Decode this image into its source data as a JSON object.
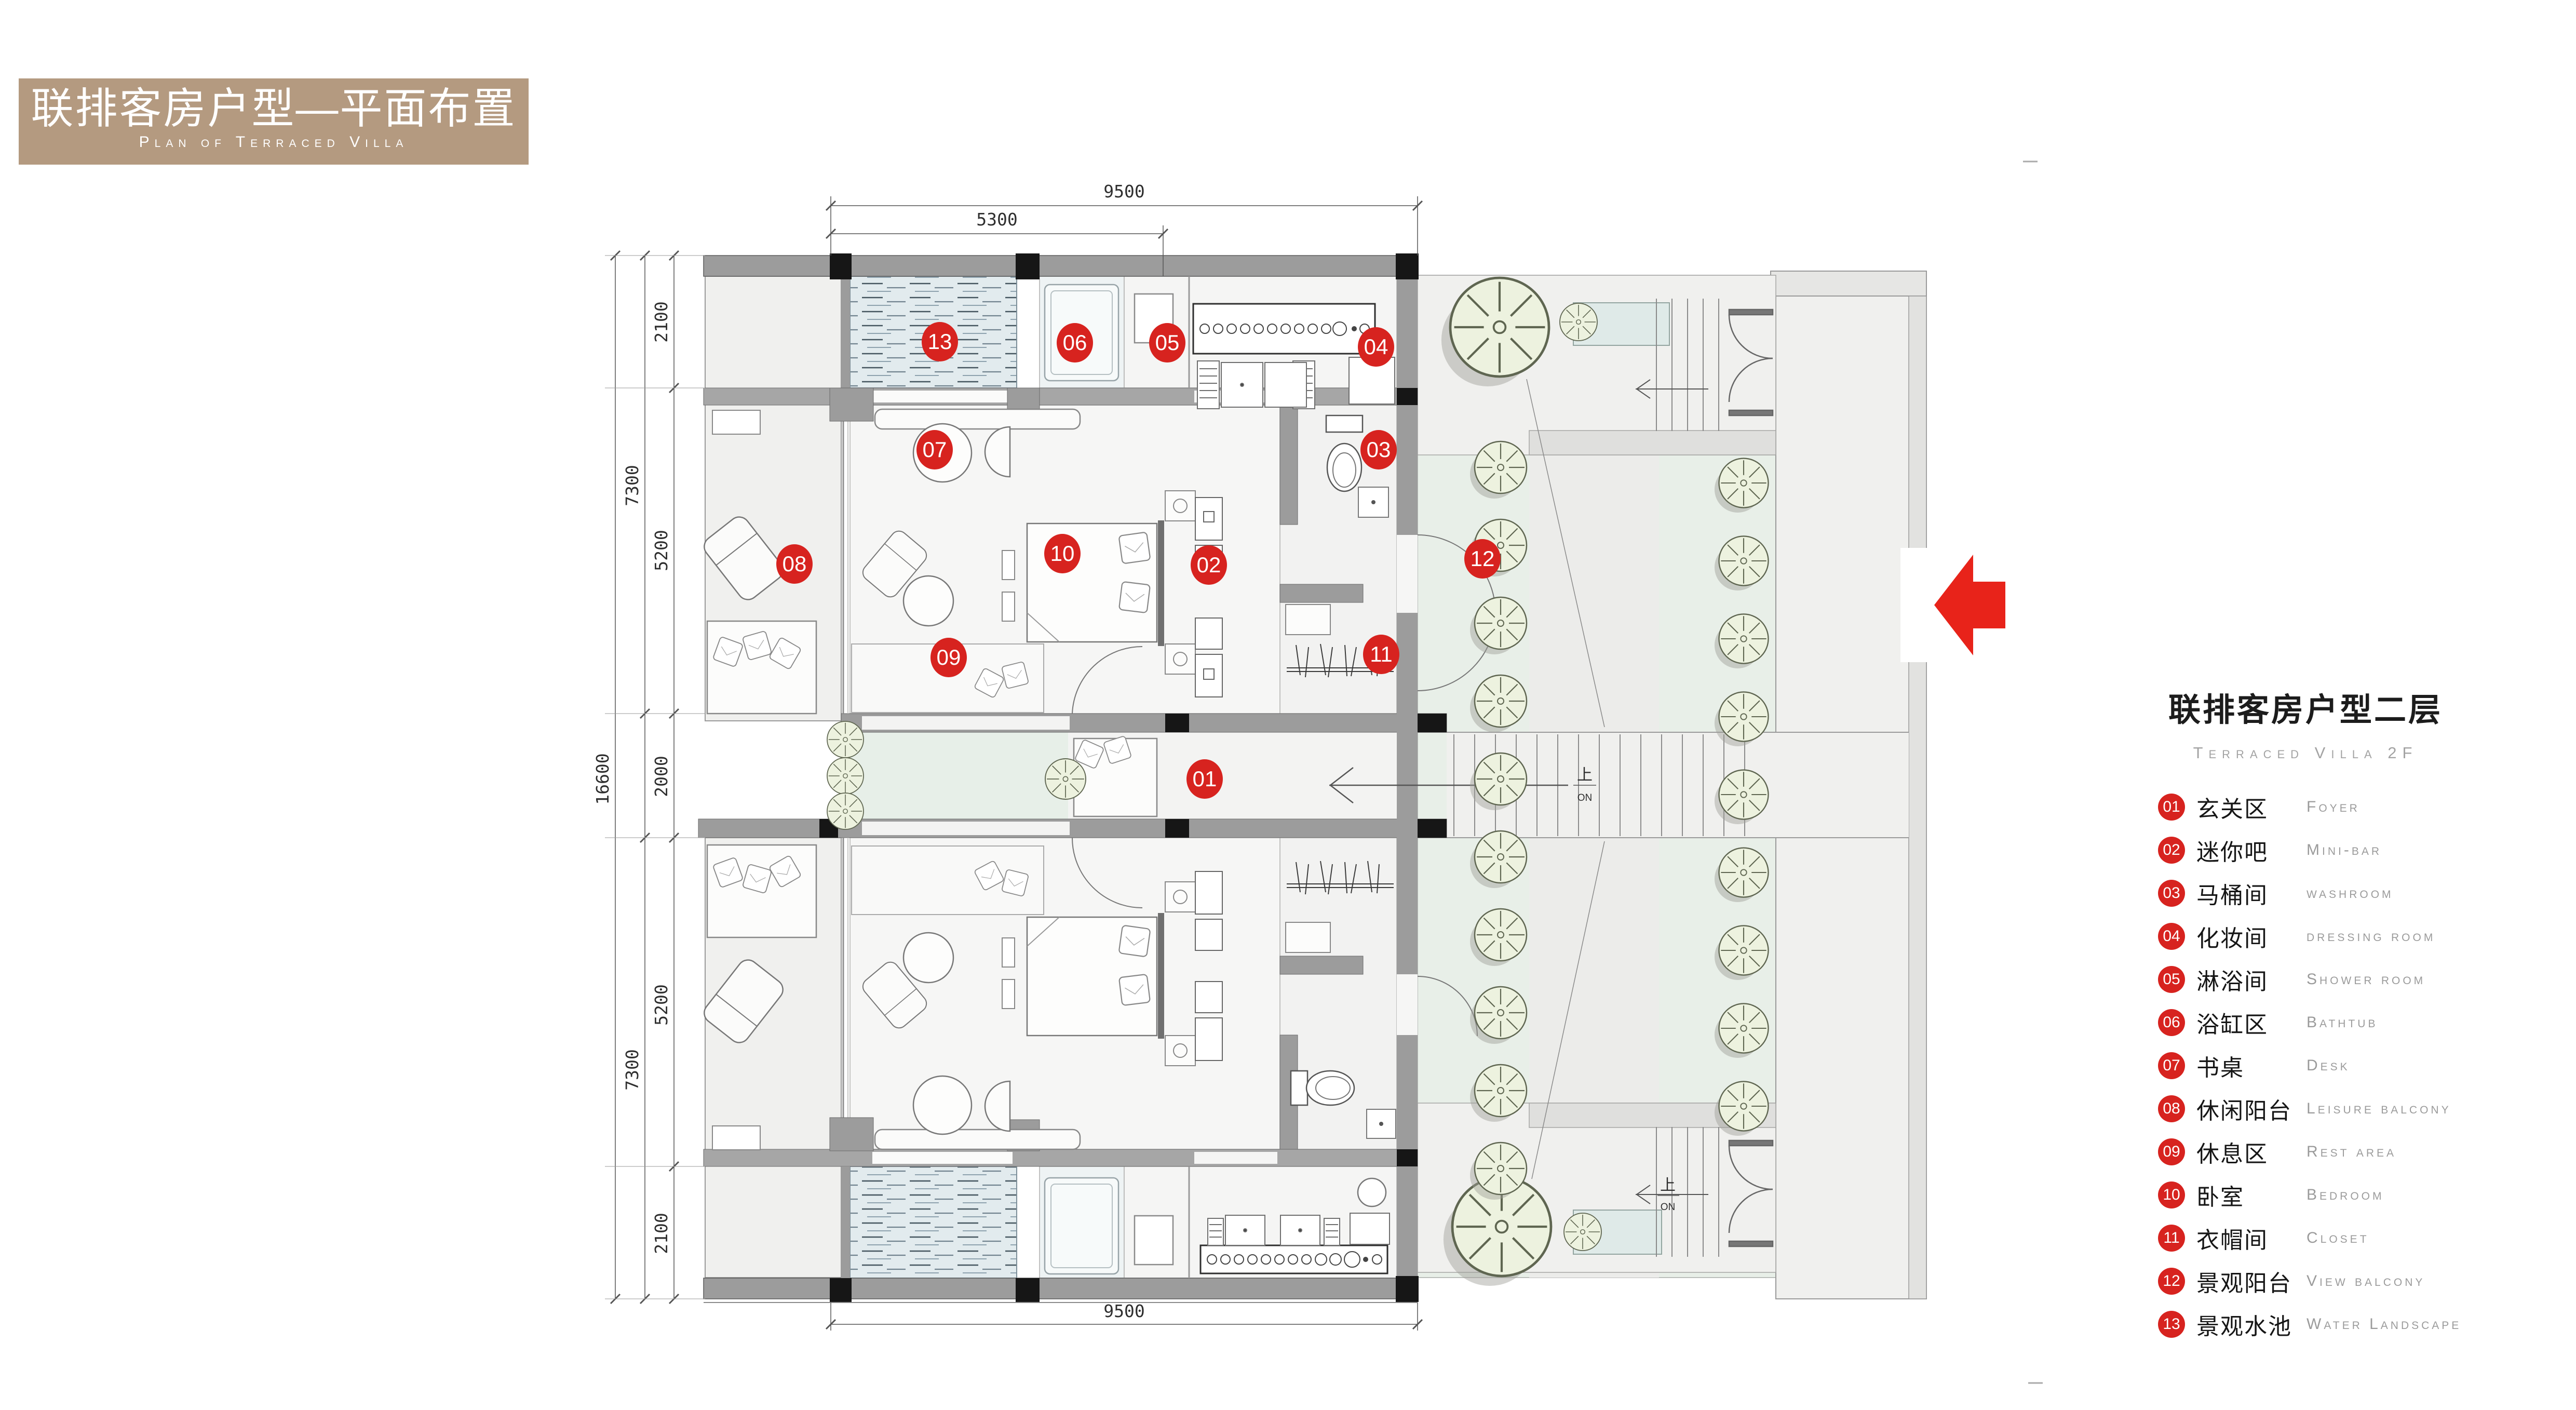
{
  "header": {
    "title_zh": "联排客房户型—平面布置",
    "title_en": "Plan of Terraced Villa"
  },
  "legend": {
    "title_zh": "联排客房户型二层",
    "title_en": "Terraced Villa  2F",
    "items": [
      {
        "num": "01",
        "zh": "玄关区",
        "en": "Foyer"
      },
      {
        "num": "02",
        "zh": "迷你吧",
        "en": "Mini-bar"
      },
      {
        "num": "03",
        "zh": "马桶间",
        "en": "washroom"
      },
      {
        "num": "04",
        "zh": "化妆间",
        "en": "dressing room"
      },
      {
        "num": "05",
        "zh": "淋浴间",
        "en": "Shower room"
      },
      {
        "num": "06",
        "zh": "浴缸区",
        "en": "Bathtub"
      },
      {
        "num": "07",
        "zh": "书桌",
        "en": "Desk"
      },
      {
        "num": "08",
        "zh": "休闲阳台",
        "en": "Leisure balcony"
      },
      {
        "num": "09",
        "zh": "休息区",
        "en": "Rest area"
      },
      {
        "num": "10",
        "zh": "卧室",
        "en": "Bedroom"
      },
      {
        "num": "11",
        "zh": "衣帽间",
        "en": "Closet"
      },
      {
        "num": "12",
        "zh": "景观阳台",
        "en": "View balcony"
      },
      {
        "num": "13",
        "zh": "景观水池",
        "en": "Water Landscape"
      }
    ]
  },
  "plan": {
    "markers": [
      {
        "num": "01"
      },
      {
        "num": "02"
      },
      {
        "num": "03"
      },
      {
        "num": "04"
      },
      {
        "num": "05"
      },
      {
        "num": "06"
      },
      {
        "num": "07"
      },
      {
        "num": "08"
      },
      {
        "num": "09"
      },
      {
        "num": "10"
      },
      {
        "num": "11"
      },
      {
        "num": "12"
      },
      {
        "num": "13"
      }
    ],
    "dims": {
      "width_total": "9500",
      "width_left": "5300",
      "width_total_bottom": "9500",
      "height_total": "16600",
      "height_upper": "7300",
      "height_lower": "7300",
      "segments": [
        "2100",
        "5200",
        "2000",
        "5200",
        "2100"
      ]
    },
    "stairs": {
      "up_zh": "上",
      "up_en": "ON"
    }
  },
  "colors": {
    "accent_red": "#d7231f",
    "title_bar_tan": "#b49a80",
    "wall_grey": "#9c9c9c",
    "garden_green": "#e8efe8",
    "water_blue": "#e2ebee"
  }
}
